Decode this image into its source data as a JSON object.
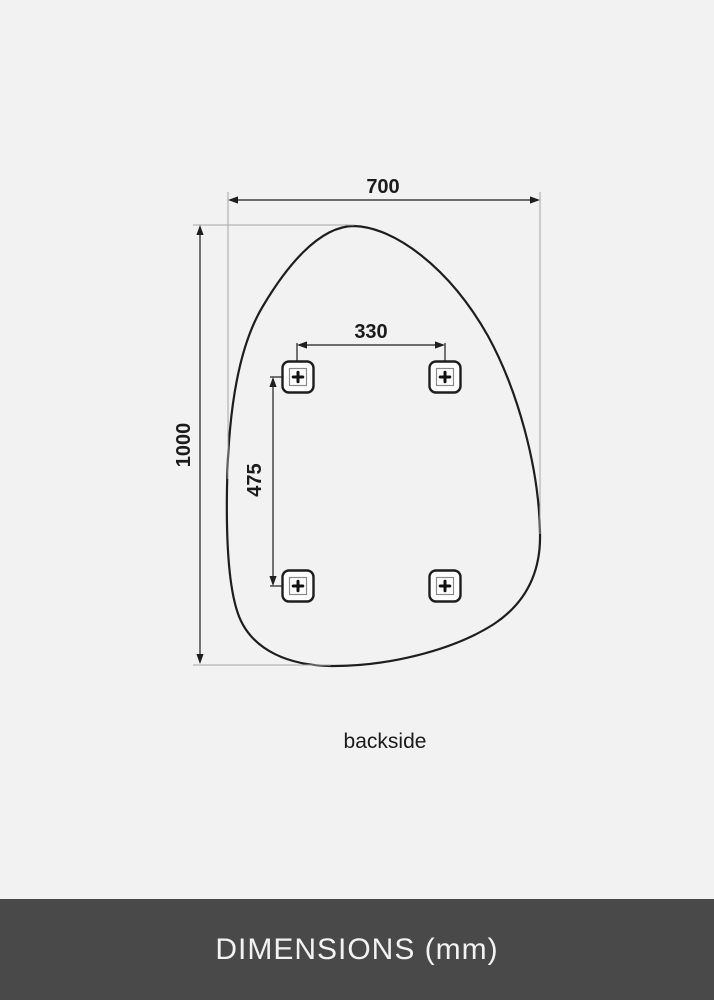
{
  "diagram": {
    "width_mm": "700",
    "height_mm": "1000",
    "hole_spacing_horizontal_mm": "330",
    "hole_spacing_vertical_mm": "475",
    "view_label": "backside",
    "mounting_brackets_count": 4,
    "icons": {
      "bracket": "screw-cross-icon"
    }
  },
  "footer": {
    "title": "DIMENSIONS (mm)"
  },
  "colors": {
    "background": "#f2f2f2",
    "line": "#1e1e1e",
    "extension_line": "#a5a5a5",
    "label_text": "#1b1b1b",
    "footer_background": "#494949",
    "footer_text": "#f2f2f2",
    "bracket_fill": "#ffffff"
  }
}
